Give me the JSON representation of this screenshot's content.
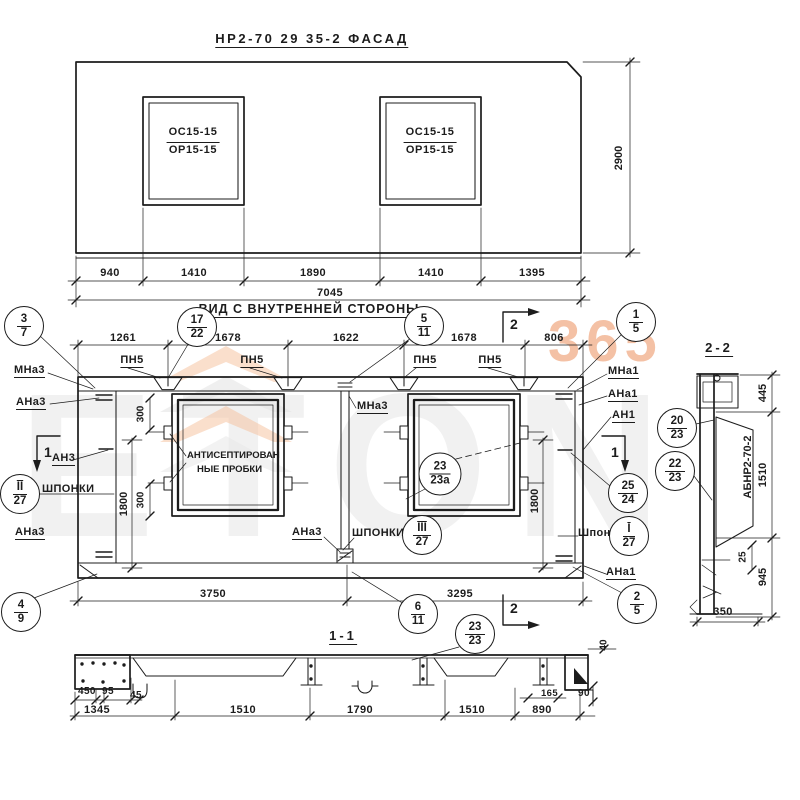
{
  "watermark": {
    "logo": "ETON",
    "badge": "365"
  },
  "facade": {
    "title": "НР2-70 29 35-2   ФАСАД",
    "win_top": "ОС15-15",
    "win_bot": "ОР15-15",
    "dims": [
      "940",
      "1410",
      "1890",
      "1410",
      "1395"
    ],
    "total": "7045",
    "height": "2900"
  },
  "inner": {
    "title": "ВИД С ВНУТРЕННЕЙ СТОРОНЫ",
    "pn5": "ПН5",
    "dims_top": [
      "1261",
      "1678",
      "1622",
      "1678",
      "806"
    ],
    "dims_bottom": [
      "3750",
      "3295"
    ],
    "dim_300": "300",
    "dim_1800": "1800",
    "labels": {
      "mna3": "МНа3",
      "ana3": "АНа3",
      "an3": "АН3",
      "shponki": "ШПОНКИ",
      "shponki_r": "Шпонки",
      "mna1": "МНа1",
      "ana1": "АНа1",
      "an1": "АН1",
      "plugs1": "АНТИСЕПТИРОВАН",
      "plugs2": "НЫЕ ПРОБКИ"
    }
  },
  "cuts": {
    "c1": "1",
    "c2": "2"
  },
  "callouts": {
    "c3_7": {
      "t": "3",
      "b": "7"
    },
    "c17_22": {
      "t": "17",
      "b": "22"
    },
    "c5_11": {
      "t": "5",
      "b": "11"
    },
    "c1_5": {
      "t": "1",
      "b": "5"
    },
    "c4_9": {
      "t": "4",
      "b": "9"
    },
    "c6_11": {
      "t": "6",
      "b": "11"
    },
    "c2_5": {
      "t": "2",
      "b": "5"
    },
    "c25_24": {
      "t": "25",
      "b": "24"
    },
    "c20_23": {
      "t": "20",
      "b": "23"
    },
    "c22_23": {
      "t": "22",
      "b": "23"
    },
    "cI_27": {
      "t": "I",
      "b": "27"
    },
    "cII_27": {
      "t": "II",
      "b": "27"
    },
    "cIII_27": {
      "t": "III",
      "b": "27"
    },
    "c23_23a": {
      "t": "23",
      "b": "23а"
    },
    "c23_23": {
      "t": "23",
      "b": "23"
    }
  },
  "section22": {
    "title": "2-2",
    "panel": "АБНР2-70-2",
    "dims": [
      "445",
      "1510",
      "945"
    ],
    "d25": "25",
    "d350": "350"
  },
  "section11": {
    "title": "1-1",
    "dims": [
      "1345",
      "1510",
      "1790",
      "1510",
      "890"
    ],
    "d450": "450",
    "d95": "95",
    "d45": "45",
    "d165": "165",
    "d90": "90",
    "d40": "40"
  }
}
